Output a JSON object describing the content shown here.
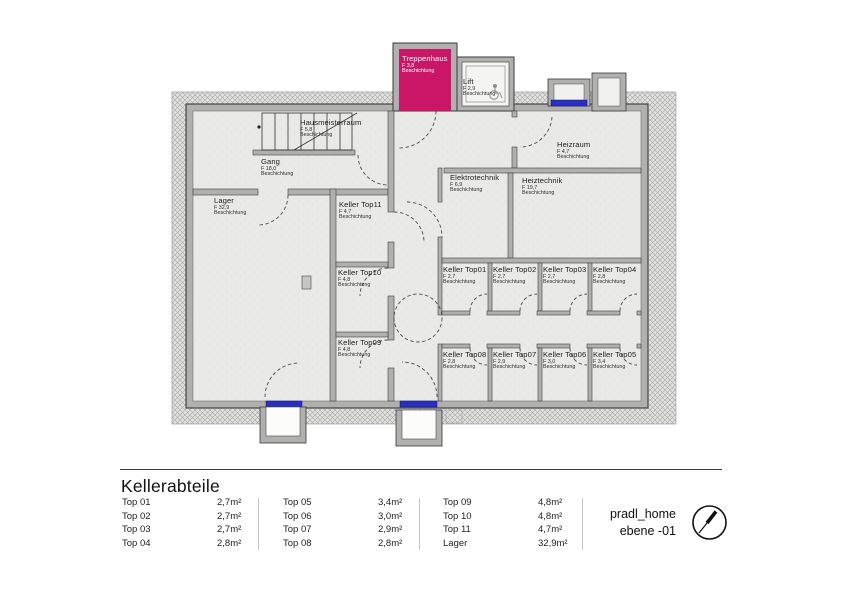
{
  "plan": {
    "rooms": [
      {
        "name": "Treppenhaus",
        "size": "F 3,8",
        "coating": "Beschichtung"
      },
      {
        "name": "Lift",
        "size": "F 2,9",
        "coating": "Beschichtung"
      },
      {
        "name": "Hausmeisterraum",
        "size": "F 5,8",
        "coating": "Beschichtung"
      },
      {
        "name": "Gang",
        "size": "F 18,0",
        "coating": "Beschichtung"
      },
      {
        "name": "Lager",
        "size": "F 32,9",
        "coating": "Beschichtung"
      },
      {
        "name": "Keller Top11",
        "size": "F 4,7",
        "coating": "Beschichtung"
      },
      {
        "name": "Keller Top10",
        "size": "F 4,8",
        "coating": "Beschichtung"
      },
      {
        "name": "Keller Top09",
        "size": "F 4,8",
        "coating": "Beschichtung"
      },
      {
        "name": "Elektrotechnik",
        "size": "F 6,9",
        "coating": "Beschichtung"
      },
      {
        "name": "Heiztechnik",
        "size": "F 19,7",
        "coating": "Beschichtung"
      },
      {
        "name": "Heizraum",
        "size": "F 4,7",
        "coating": "Beschichtung"
      },
      {
        "name": "Keller Top01",
        "size": "F 2,7",
        "coating": "Beschichtung"
      },
      {
        "name": "Keller Top02",
        "size": "F 2,7",
        "coating": "Beschichtung"
      },
      {
        "name": "Keller Top03",
        "size": "F 2,7",
        "coating": "Beschichtung"
      },
      {
        "name": "Keller Top04",
        "size": "F 2,8",
        "coating": "Beschichtung"
      },
      {
        "name": "Keller Top08",
        "size": "F 2,8",
        "coating": "Beschichtung"
      },
      {
        "name": "Keller Top07",
        "size": "F 2,9",
        "coating": "Beschichtung"
      },
      {
        "name": "Keller Top06",
        "size": "F 3,0",
        "coating": "Beschichtung"
      },
      {
        "name": "Keller Top05",
        "size": "F 3,4",
        "coating": "Beschichtung"
      }
    ],
    "colors": {
      "stairwell_magenta": "#cb1668",
      "window_blue": "#2b2fbe"
    }
  },
  "legend": {
    "title": "Kellerabteile",
    "columns": [
      [
        {
          "label": "Top 01",
          "area": "2,7m²"
        },
        {
          "label": "Top 02",
          "area": "2,7m²"
        },
        {
          "label": "Top 03",
          "area": "2,7m²"
        },
        {
          "label": "Top 04",
          "area": "2,8m²"
        }
      ],
      [
        {
          "label": "Top 05",
          "area": "3,4m²"
        },
        {
          "label": "Top 06",
          "area": "3,0m²"
        },
        {
          "label": "Top 07",
          "area": "2,9m²"
        },
        {
          "label": "Top 08",
          "area": "2,8m²"
        }
      ],
      [
        {
          "label": "Top 09",
          "area": "4,8m²"
        },
        {
          "label": "Top 10",
          "area": "4,8m²"
        },
        {
          "label": "Top 11",
          "area": "4,7m²"
        },
        {
          "label": "Lager",
          "area": "32,9m²"
        }
      ]
    ],
    "project": "pradl_home",
    "level": "ebene -01"
  }
}
